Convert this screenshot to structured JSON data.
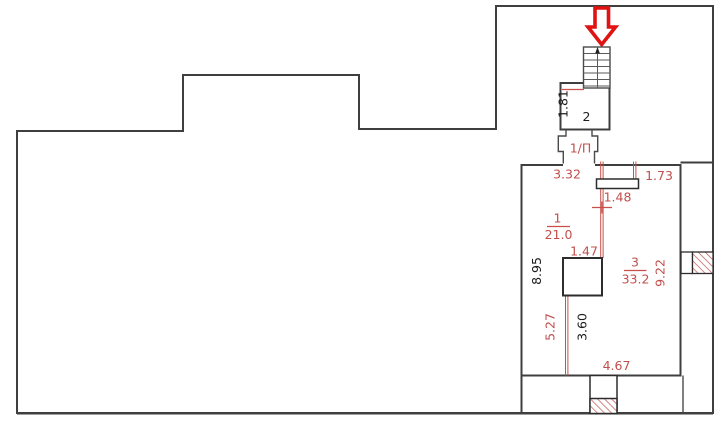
{
  "title": "apartment-floor-plan",
  "rooms": {
    "room1": {
      "number": "1",
      "area": "21.0"
    },
    "room2": {
      "number": "2"
    },
    "room3": {
      "number": "3",
      "area": "33.2"
    },
    "passage_label": "1/П"
  },
  "dimensions": {
    "stair_room_width": "1.81",
    "top_left": "3.32",
    "top_right": "1.73",
    "duct_offset": "1.48",
    "column_width": "1.47",
    "left_height": "8.95",
    "right_height": "9.22",
    "partition_length": "5.27",
    "inner_height": "3.60",
    "bottom_width": "4.67"
  },
  "icons": {
    "entrance_arrow": "down-arrow-icon",
    "stairs_direction": "up-arrow-icon"
  },
  "colors": {
    "wall": "#3f3f3f",
    "dimension_red": "#c0504d",
    "partition_red": "#c9504a",
    "entrance_arrow_red": "#e01212",
    "hatch_red": "#c0504d",
    "black_text": "#1c1c1c",
    "background": "#ffffff"
  }
}
